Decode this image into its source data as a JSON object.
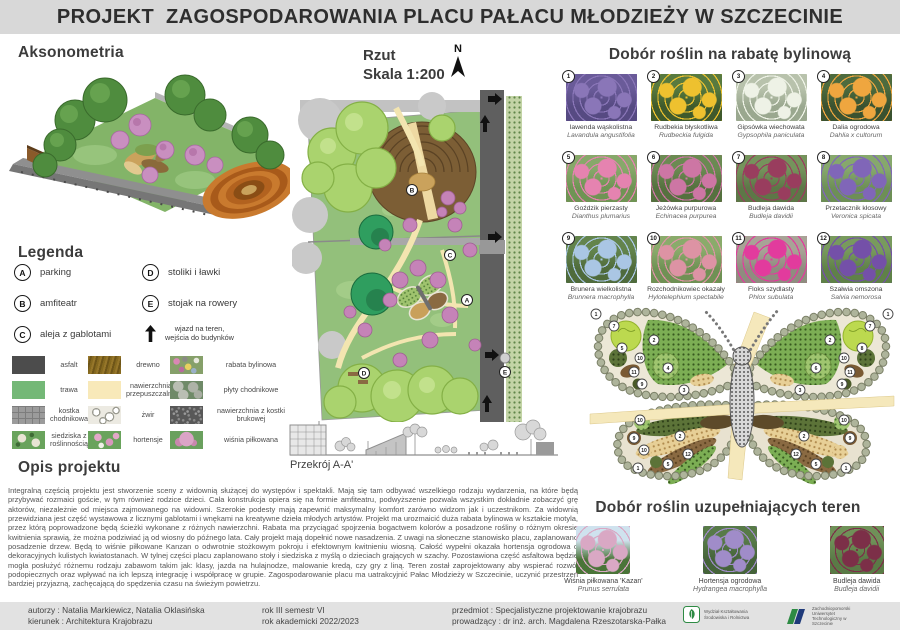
{
  "title": "PROJEKT  ZAGOSPODAROWANIA PLACU PAŁACU MŁODZIEŻY W SZCZECINIE",
  "sections": {
    "aksonometria": "Aksonometria",
    "rzut": "Rzut",
    "skala": "Skala 1:200",
    "north": "N",
    "przekroj": "Przekrój A-A'"
  },
  "legend": {
    "heading": "Legenda",
    "items": [
      {
        "key": "A",
        "label": "parking"
      },
      {
        "key": "B",
        "label": "amfiteatr"
      },
      {
        "key": "C",
        "label": "aleja z gablotami"
      },
      {
        "key": "D",
        "label": "stoliki i ławki"
      },
      {
        "key": "E",
        "label": "stojak na rowery"
      }
    ],
    "entry_line1": "wjazd na teren,",
    "entry_line2": "wejścia do budynków"
  },
  "materials": [
    {
      "name": "asfalt",
      "swatch": "asphalt"
    },
    {
      "name": "drewno",
      "swatch": "wood"
    },
    {
      "name": "rabata bylinowa",
      "swatch": "perennial-bed"
    },
    {
      "name": "trawa",
      "swatch": "grass"
    },
    {
      "name": "nawierzchnia przepuszczalna",
      "swatch": "permeable"
    },
    {
      "name": "płyty chodnikowe",
      "swatch": "slabs"
    },
    {
      "name": "kostka chodnikowa",
      "swatch": "cobble"
    },
    {
      "name": "żwir",
      "swatch": "gravel"
    },
    {
      "name": "nawierzchnia z kostki brukowej",
      "swatch": "brick"
    },
    {
      "name": "siedziska z roślinnością",
      "swatch": "seats"
    },
    {
      "name": "hortensje",
      "swatch": "hydrangea"
    },
    {
      "name": "wiśnia piłkowana",
      "swatch": "cherry"
    }
  ],
  "opis": {
    "heading": "Opis projektu",
    "text": "Integralną częścią projektu jest stworzenie sceny z widownią służącej do występów i spektakli. Mają się tam odbywać wszelkiego rodzaju wydarzenia, na które będą przybywać rozmaici goście, w tym również rodzice dzieci. Cała konstrukcja opiera się na formie amfiteatru, podwyższenie pozwala wszystkim dokładnie zobaczyć grę aktorów, niezależnie od miejsca zajmowanego na widowni. Szerokie podesty mają zapewnić maksymalny komfort zarówno widzom jak i uczestnikom. Za widownią przewidziana jest część wystawowa z licznymi gablotami i wnękami na kreatywne dzieła młodych artystów. Projekt ma urozmaicić duża rabata bylinowa w kształcie motyla, przez którą poprowadzone będą ścieżki wykonane z różnych nawierzchni. Rabata ma przyciągać spojrzenia bogactwem kolorów a posadzone rośliny o różnym okresie kwitnienia sprawią, że można podziwiać ją od wiosny do późnego lata. Cały projekt mają dopełnić nowe nasadzenia. Z uwagi na słoneczne stanowisko placu, zaplanowano posadzenie drzew. Będą to wiśnie piłkowane Kanzan o odwrotnie stożkowym pokroju i efektownym kwitnieniu wiosną. Całość wypełni okazała hortensja ogrodowa o dekoracyjnych kulistych kwiatostanach. W tylnej części placu zaplanowano stoły i siedziska z myślą o dzieciach grających w szachy. Pozostawiona część asfaltowa będzie mogła posłużyć różnemu rodzaju zabawom takim jak: klasy, jazda na hulajnodze, malowanie kredą, czy gry z liną. Teren został zaprojektowany aby wspierać rozwój podopiecznych oraz wpływać na ich lepszą integrację i współpracę w grupie. Zagospodarowanie placu ma uatrakcyjnić Pałac Młodzieży w Szczecinie, uczynić przestrzeń bardziej przyjazną, zachęcającą do spędzenia czasu na świeżym powietrzu."
  },
  "plants_main": {
    "heading": "Dobór roślin na rabatę bylinową",
    "items": [
      {
        "num": "1",
        "name": "lawenda wąskolistna",
        "latin": "Lavandula angustifolia",
        "colors": [
          "#564a82",
          "#8a76b8",
          "#6a5b99"
        ]
      },
      {
        "num": "2",
        "name": "Rudbekia błyskotliwa",
        "latin": "Rudbeckia fulgida",
        "colors": [
          "#3f5a2c",
          "#eec12f",
          "#587a3f"
        ]
      },
      {
        "num": "3",
        "name": "Gipsówka wiechowata",
        "latin": "Gypsophila paniculata",
        "colors": [
          "#9aa88f",
          "#eef2e6",
          "#b8c2ac"
        ]
      },
      {
        "num": "4",
        "name": "Dalia ogrodowa",
        "latin": "Dahlia x cultorum",
        "colors": [
          "#3a5230",
          "#efa63f",
          "#4d6b3e"
        ]
      },
      {
        "num": "5",
        "name": "Goździk pierzasty",
        "latin": "Dianthus plumarius",
        "colors": [
          "#6f9454",
          "#e583b0",
          "#87a86a"
        ]
      },
      {
        "num": "6",
        "name": "Jeżówka purpurowa",
        "latin": "Echinacea purpurea",
        "colors": [
          "#55713f",
          "#cd76a4",
          "#6b8a52"
        ]
      },
      {
        "num": "7",
        "name": "Budleja dawida",
        "latin": "Budleja davidii",
        "colors": [
          "#5d7747",
          "#993d5e",
          "#75935c"
        ]
      },
      {
        "num": "8",
        "name": "Przetacznik kłosowy",
        "latin": "Veronica spicata",
        "colors": [
          "#6d8f56",
          "#8066b8",
          "#86a86c"
        ]
      },
      {
        "num": "9",
        "name": "Brunera wielkolistna",
        "latin": "Brunnera macrophylla",
        "colors": [
          "#4f6b3c",
          "#aac6e4",
          "#63844c"
        ]
      },
      {
        "num": "10",
        "name": "Rozchodnikowiec okazały",
        "latin": "Hylotelephium spectabile",
        "colors": [
          "#6f9154",
          "#dd93a4",
          "#8aab6b"
        ]
      },
      {
        "num": "11",
        "name": "Floks szydlasty",
        "latin": "Phlox subulata",
        "colors": [
          "#8f8c7f",
          "#e23b9d",
          "#a8a396"
        ]
      },
      {
        "num": "12",
        "name": "Szałwia omszona",
        "latin": "Salvia nemorosa",
        "colors": [
          "#5f8148",
          "#7450a8",
          "#789a5d"
        ]
      }
    ]
  },
  "plants_extra": {
    "heading": "Dobór roślin uzupełniających teren",
    "items": [
      {
        "name": "Wiśnia piłkowana 'Kazan'",
        "latin": "Prunus serrulata",
        "colors": [
          "#4a7438",
          "#d9a8c4",
          "#cfe2ee"
        ]
      },
      {
        "name": "Hortensja ogrodowa",
        "latin": "Hydrangea macrophylla",
        "colors": [
          "#45633a",
          "#a08cc9",
          "#577a48"
        ]
      },
      {
        "name": "Budleja dawida",
        "latin": "Budleja davidii",
        "colors": [
          "#5a7a46",
          "#7c2f48",
          "#6f9158"
        ]
      }
    ]
  },
  "butterfly": {
    "markers": [
      {
        "n": "1",
        "x": 10,
        "y": 12
      },
      {
        "n": "7",
        "x": 28,
        "y": 24
      },
      {
        "n": "2",
        "x": 68,
        "y": 38
      },
      {
        "n": "5",
        "x": 36,
        "y": 46
      },
      {
        "n": "10",
        "x": 54,
        "y": 56
      },
      {
        "n": "11",
        "x": 48,
        "y": 70
      },
      {
        "n": "4",
        "x": 82,
        "y": 66
      },
      {
        "n": "9",
        "x": 56,
        "y": 82
      },
      {
        "n": "3",
        "x": 98,
        "y": 88
      },
      {
        "n": "1",
        "x": 302,
        "y": 12
      },
      {
        "n": "7",
        "x": 284,
        "y": 24
      },
      {
        "n": "2",
        "x": 244,
        "y": 38
      },
      {
        "n": "8",
        "x": 276,
        "y": 46
      },
      {
        "n": "10",
        "x": 258,
        "y": 56
      },
      {
        "n": "11",
        "x": 264,
        "y": 70
      },
      {
        "n": "6",
        "x": 230,
        "y": 66
      },
      {
        "n": "9",
        "x": 256,
        "y": 82
      },
      {
        "n": "3",
        "x": 214,
        "y": 88
      },
      {
        "n": "10",
        "x": 54,
        "y": 118
      },
      {
        "n": "2",
        "x": 94,
        "y": 134
      },
      {
        "n": "9",
        "x": 48,
        "y": 136
      },
      {
        "n": "10",
        "x": 58,
        "y": 148
      },
      {
        "n": "12",
        "x": 102,
        "y": 152
      },
      {
        "n": "5",
        "x": 82,
        "y": 162
      },
      {
        "n": "1",
        "x": 52,
        "y": 166
      },
      {
        "n": "10",
        "x": 258,
        "y": 118
      },
      {
        "n": "2",
        "x": 218,
        "y": 134
      },
      {
        "n": "9",
        "x": 264,
        "y": 136
      },
      {
        "n": "12",
        "x": 210,
        "y": 152
      },
      {
        "n": "5",
        "x": 230,
        "y": 162
      },
      {
        "n": "1",
        "x": 260,
        "y": 166
      }
    ]
  },
  "plan_letters": [
    {
      "key": "B",
      "x": 120,
      "y": 100
    },
    {
      "key": "C",
      "x": 158,
      "y": 165
    },
    {
      "key": "A",
      "x": 175,
      "y": 210
    },
    {
      "key": "D",
      "x": 72,
      "y": 283
    },
    {
      "key": "E",
      "x": 213,
      "y": 282
    }
  ],
  "footer": {
    "autorzy": "autorzy : Natalia Markiewicz, Natalia Oklasińska",
    "kierunek": "kierunek : Architektura Krajobrazu",
    "rok": "rok III semestr VI",
    "rok_akademicki": "rok akademicki 2022/2023",
    "przedmiot": "przedmiot : Specjalistyczne projektowanie krajobrazu",
    "prowadzacy": "prowadzący : dr inż. arch. Magdalena Rzeszotarska-Pałka",
    "logo1": "Wydział Kształtowania Środowiska i Rolnictwa",
    "logo2": "Zachodniopomorski Uniwersytet Technologiczny w Szczecinie"
  },
  "colors": {
    "title_bar": "#d8d8d8",
    "footer_bar": "#e2e2e2",
    "grass_green": "#74b877",
    "path_cream": "#f3e5b0",
    "road_gray": "#5f5f5f",
    "amphitheater_brown": "#7c5e35"
  }
}
